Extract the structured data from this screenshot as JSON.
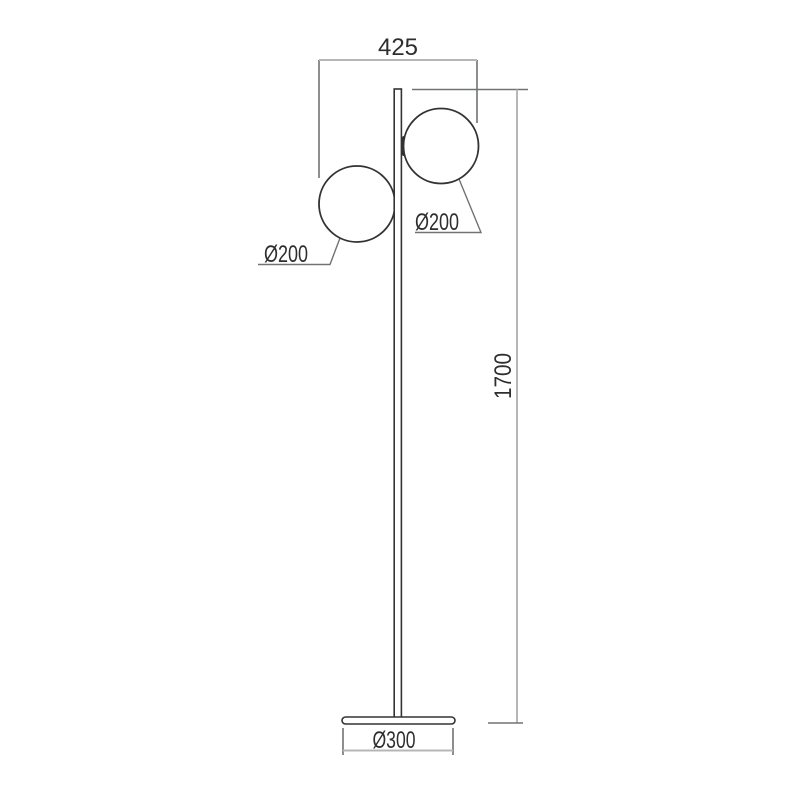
{
  "colors": {
    "bg": "#ffffff",
    "line": "#333333",
    "dim": "#b5b7b7",
    "ext": "#707274",
    "text": "#2e2e2e"
  },
  "drawing": {
    "kind": "floor-lamp dimension drawing, two sphere shades on a straight pole with round base",
    "labels": {
      "width_top": "425",
      "height": "1700",
      "globe_right_diameter": "Ø200",
      "globe_left_diameter": "Ø200",
      "base_diameter": "Ø300"
    }
  }
}
